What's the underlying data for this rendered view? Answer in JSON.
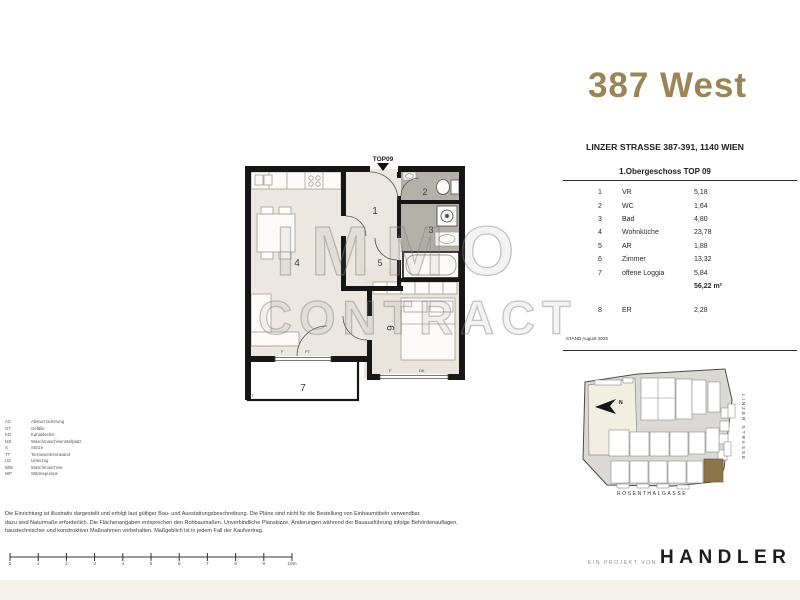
{
  "title": {
    "text": "387 West",
    "color": "#9B8455"
  },
  "project": {
    "address": "LINZER STRASSE 387-391, 1140 WIEN",
    "floor_heading": "1.Obergeschoss TOP 09",
    "stand": "STAND August 2025"
  },
  "area_table": {
    "rows": [
      {
        "num": "1",
        "name": "VR",
        "area": "5,18"
      },
      {
        "num": "2",
        "name": "WC",
        "area": "1,64"
      },
      {
        "num": "3",
        "name": "Bad",
        "area": "4,80"
      },
      {
        "num": "4",
        "name": "Wohnküche",
        "area": "23,78"
      },
      {
        "num": "5",
        "name": "AR",
        "area": "1,88"
      },
      {
        "num": "6",
        "name": "Zimmer",
        "area": "13,32"
      },
      {
        "num": "7",
        "name": "offene Loggia",
        "area": "5,84"
      }
    ],
    "total": "56,22 m²",
    "extra_row": {
      "num": "8",
      "name": "ER",
      "area": "2,28"
    }
  },
  "plan": {
    "entry_label": "TOP09",
    "room_numbers": [
      "1",
      "2",
      "3",
      "4",
      "5",
      "6",
      "7"
    ],
    "divider_label": "TT",
    "window_labels": {
      "w4_f": "F",
      "w4_ft": "FT",
      "w6_f": "F",
      "w6_dk": "DK"
    }
  },
  "watermark": {
    "line1": "IMMO",
    "line2": "CONTRACT"
  },
  "site_map": {
    "north_label": "N",
    "street_right": "LINZER STRASSE",
    "street_bottom": "ROSENTHALGASSE",
    "highlight_color": "#8C7547"
  },
  "legend": {
    "items": [
      {
        "abbr": "AS",
        "label": "Absturzsicherung"
      },
      {
        "abbr": "GT",
        "label": "Gefälle"
      },
      {
        "abbr": "KD",
        "label": "Kanaldeckel"
      },
      {
        "abbr": "MS",
        "label": "Waschmaschinenstellplatz"
      },
      {
        "abbr": "S",
        "label": "Stütze"
      },
      {
        "abbr": "TT",
        "label": "Terrassentrennwand"
      },
      {
        "abbr": "UZ",
        "label": "Unterzug"
      },
      {
        "abbr": "WM",
        "label": "Waschmaschine"
      },
      {
        "abbr": "WP",
        "label": "Wärmepumpe"
      }
    ]
  },
  "disclaimer": {
    "line1": "Die Einrichtung ist illustrativ dargestellt und erfolgt laut gültiger Bau- und Ausstattungsbeschreibung. Die Pläne sind nicht für die Bestellung von Einbaumöbeln verwendbar,",
    "line2": "dazu sind Naturmaße erforderlich. Die Flächenangaben entsprechen den Rohbaumaßen. Unverbindliche Planskizze, Änderungen während der Bauausführung infolge Behördenauflagen,",
    "line3": "haustechnischer und konstruktiver Maßnahmen vorbehalten. Maßgeblich ist in jedem Fall der Kaufvertrag."
  },
  "scale_bar": {
    "labels": [
      "0",
      "1",
      "2",
      "3",
      "4",
      "5",
      "6",
      "7",
      "8",
      "9",
      "10m"
    ]
  },
  "footer": {
    "prefix": "EIN PROJEKT VON",
    "brand": "HANDLER"
  }
}
